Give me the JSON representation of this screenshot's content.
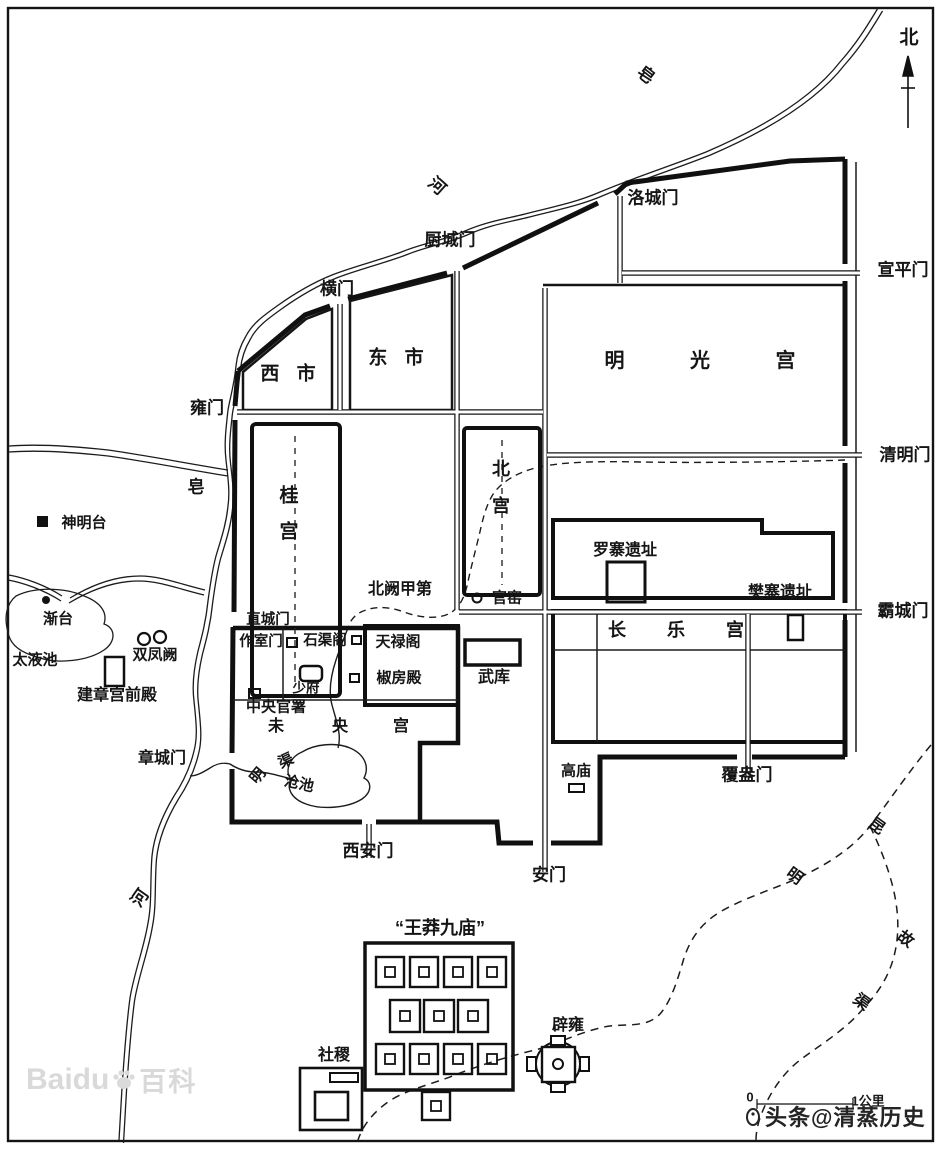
{
  "compass": {
    "north": "北"
  },
  "rivers": {
    "zao": "皂",
    "he": "河"
  },
  "gates": {
    "luocheng": "洛城门",
    "xuanping": "宣平门",
    "chucheng": "厨城门",
    "hengmen": "横门",
    "yongmen": "雍门",
    "qingmingmen": "清明门",
    "bachengmen": "霸城门",
    "zhichengmen": "直城门",
    "zuoshimen": "作室门",
    "zhangchengmen": "章城门",
    "xianmen": "西安门",
    "anmen": "安门",
    "fuangmen": "覆盎门"
  },
  "markets": {
    "west": "西 市",
    "east": "东 市"
  },
  "palaces": {
    "mingguang": "明 光 宫",
    "gui1": "桂",
    "gui2": "宫",
    "bei1": "北",
    "bei2": "宫",
    "changle": "长 乐 宫",
    "wei": "未",
    "yang": "央",
    "gong": "宫",
    "jianzhang": "建章宫前殿"
  },
  "sites": {
    "shenmingtai": "神明台",
    "jiantai": "渐台",
    "taiyechi": "太液池",
    "shuangfengque": "双凤阙",
    "luozhai": "罗寨遗址",
    "fanzhai": "樊寨遗址",
    "beiquejiadi": "北阙甲第",
    "guanyao": "官窑",
    "wuku": "武库",
    "shiquge": "石渠阁",
    "tianluge": "天禄阁",
    "jiaofangdian": "椒房殿",
    "shaofu": "少府",
    "zhongyangguanshu": "中央官署",
    "gaomiao": "高庙",
    "cangchi": "沧池",
    "mingqu_ming": "明",
    "mingqu_qu": "渠",
    "sheji": "社稷",
    "biyong": "辟雍",
    "wangmangjiumiao": "“王莽九庙”"
  },
  "channels": {
    "kun": "昆",
    "ming": "明",
    "gu": "故",
    "qu": "渠"
  },
  "scalebar": {
    "zero": "0",
    "one_km": "1公里"
  },
  "watermarks": {
    "baidu": "Baidu",
    "baike": "百科",
    "toutiao": "头条@清蒸历史"
  }
}
